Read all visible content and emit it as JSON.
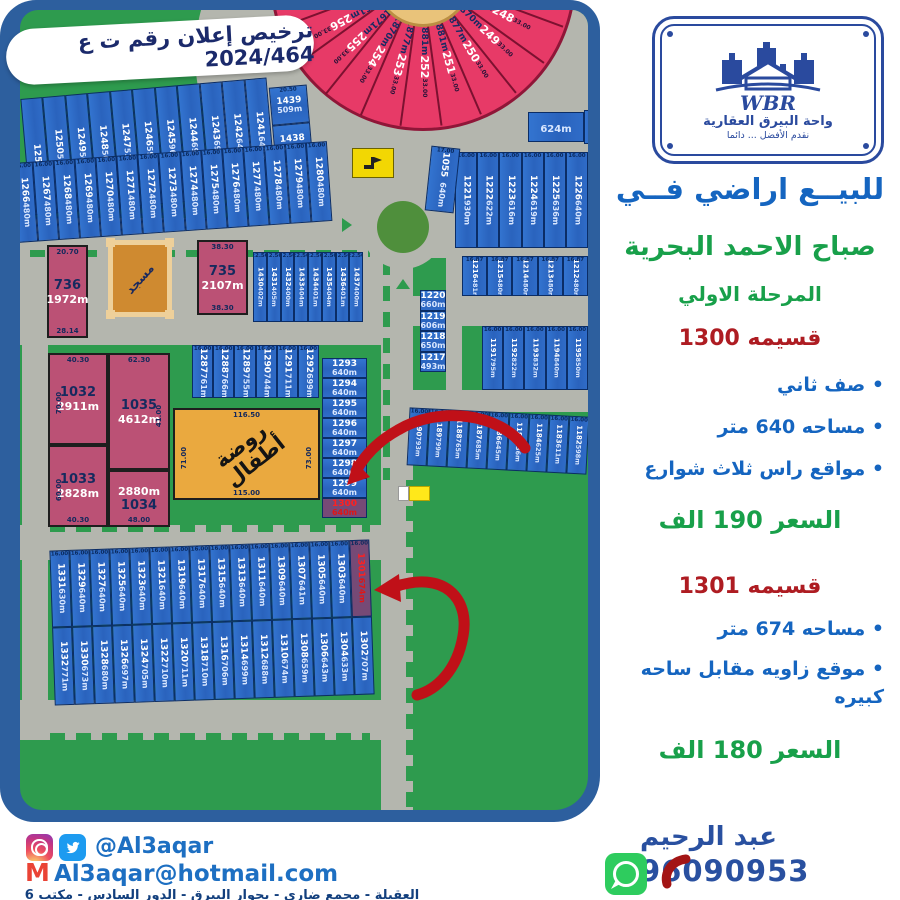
{
  "license_banner": "ترخيص إعلان رقم ت ع 2024/464",
  "logo": {
    "wbr": "WBR",
    "name": "واحة البيرق العقارية",
    "slogan": "نقدم الأفضل ... دائما"
  },
  "panel": {
    "title": "للبيــع اراضي فــي",
    "subtitle": "صباح الاحمد البحرية",
    "phase": "المرحلة الاولي",
    "sections": [
      {
        "heading": "قسيمه 1300",
        "bullets": [
          "صف ثاني",
          "مساحه 640 متر",
          "مواقع راس ثلاث شوارع"
        ],
        "price": "السعر 190 الف"
      },
      {
        "heading": "قسيمه 1301",
        "bullets": [
          "مساحه 674 متر",
          "موقع زاويه مقابل ساحه كبيره"
        ],
        "price": "السعر 180 الف"
      }
    ],
    "agent": "عبد الرحيم",
    "phone": "96090953"
  },
  "contact": {
    "social_handle": "@Al3aqar",
    "email": "Al3aqar@hotmail.com",
    "address": "العقيلة - مجمع ضاري - بجوار البيرق - الدور السادس - مكتب 6"
  },
  "map": {
    "mosque": "مسجد",
    "kindergarten": {
      "label": "روضة أطفال",
      "dt": "116.50",
      "dl": "71.00",
      "db": "115.00",
      "dr": "73.00"
    },
    "fan": {
      "arc_dim": "33.00",
      "wedges": [
        {
          "area": "1868m",
          "num": "248"
        },
        {
          "area": "1870m",
          "num": "249"
        },
        {
          "area": "1877m",
          "num": "250"
        },
        {
          "area": "1881m",
          "num": "251"
        },
        {
          "area": "1881m",
          "num": "252"
        },
        {
          "area": "1877m",
          "num": "253"
        },
        {
          "area": "1870m",
          "num": "254"
        },
        {
          "area": "1671m",
          "num": "255"
        },
        {
          "area": "1661m",
          "num": "256"
        }
      ]
    },
    "plots": {
      "p736": {
        "n": "736",
        "a": "1972m",
        "dt": "20.70",
        "db": "28.14"
      },
      "p735": {
        "n": "735",
        "a": "2107m",
        "dt": "38.30",
        "db": "38.30"
      },
      "p1032": {
        "n": "1032",
        "a": "2911m",
        "dt": "40.30",
        "dl": "70.00"
      },
      "p1035": {
        "n": "1035",
        "a": "4612m",
        "dt": "62.30",
        "dr": "41.00"
      },
      "p1033": {
        "n": "1033",
        "a": "2828m",
        "dl": "60.00",
        "db": "40.30"
      },
      "p1034": {
        "n": "1034",
        "a": "2880m",
        "db": "48.00"
      },
      "p624": {
        "a": "624m"
      },
      "p986": {
        "n": "986"
      },
      "p1055": {
        "n": "1055",
        "a": "640m",
        "d": "17.00"
      }
    },
    "rows": {
      "r1251": {
        "plots": [
          {
            "n": "1251",
            "a": ""
          },
          {
            "n": "1250",
            "a": "522m"
          },
          {
            "n": "1249",
            "a": "507m"
          },
          {
            "n": "1248",
            "a": "505m"
          },
          {
            "n": "1247",
            "a": "531m"
          },
          {
            "n": "1246",
            "a": "598m"
          },
          {
            "n": "1245",
            "a": "969m"
          },
          {
            "n": "1244",
            "a": "695m"
          },
          {
            "n": "1243",
            "a": "695m"
          },
          {
            "n": "1242",
            "a": "640m"
          },
          {
            "n": "1241",
            "a": "640m"
          }
        ]
      },
      "c1439": {
        "plots": [
          {
            "n": "1439",
            "a": "509m",
            "d": "20.50"
          },
          {
            "n": "1438",
            "a": "532m"
          }
        ]
      },
      "r1266": {
        "dim": "16.00",
        "plots": [
          {
            "n": "1266",
            "a": "480m"
          },
          {
            "n": "1267",
            "a": "480m"
          },
          {
            "n": "1268",
            "a": "480m"
          },
          {
            "n": "1269",
            "a": "480m"
          },
          {
            "n": "1270",
            "a": "480m"
          },
          {
            "n": "1271",
            "a": "480m"
          },
          {
            "n": "1272",
            "a": "480m"
          },
          {
            "n": "1273",
            "a": "480m"
          },
          {
            "n": "1274",
            "a": "480m"
          },
          {
            "n": "1275",
            "a": "480m"
          },
          {
            "n": "1276",
            "a": "480m"
          },
          {
            "n": "1277",
            "a": "480m"
          },
          {
            "n": "1278",
            "a": "480m"
          },
          {
            "n": "1279",
            "a": "480m"
          },
          {
            "n": "1280",
            "a": "480m"
          }
        ]
      },
      "r1430": {
        "dim": "22.50",
        "plots": [
          {
            "n": "1430",
            "a": "402m"
          },
          {
            "n": "1431",
            "a": "405m"
          },
          {
            "n": "1432",
            "a": "400m"
          },
          {
            "n": "1433",
            "a": "404m"
          },
          {
            "n": "1434",
            "a": "401m"
          },
          {
            "n": "1435",
            "a": "404m"
          },
          {
            "n": "1436",
            "a": "401m"
          },
          {
            "n": "1437",
            "a": "400m"
          }
        ]
      },
      "r1287": {
        "dim": "16.00",
        "plots": [
          {
            "n": "1287",
            "a": "761m"
          },
          {
            "n": "1288",
            "a": "766m"
          },
          {
            "n": "1289",
            "a": "755m"
          },
          {
            "n": "1290",
            "a": "744m"
          },
          {
            "n": "1291",
            "a": "711m"
          },
          {
            "n": "1292",
            "a": "699m"
          }
        ]
      },
      "c1293": {
        "plots": [
          {
            "n": "1293",
            "a": "640m"
          },
          {
            "n": "1294",
            "a": "640m"
          },
          {
            "n": "1295",
            "a": "640m"
          },
          {
            "n": "1296",
            "a": "640m"
          },
          {
            "n": "1297",
            "a": "640m"
          },
          {
            "n": "1298",
            "a": "640m"
          },
          {
            "n": "1299",
            "a": "640m"
          },
          {
            "n": "1300",
            "a": "640m",
            "hl": true
          }
        ]
      },
      "r1221": {
        "dim": "16.00",
        "plots": [
          {
            "n": "1221",
            "a": "930m"
          },
          {
            "n": "1222",
            "a": "622m"
          },
          {
            "n": "1223",
            "a": "616m"
          },
          {
            "n": "1224",
            "a": "619m"
          },
          {
            "n": "1225",
            "a": "636m"
          },
          {
            "n": "1226",
            "a": "640m"
          }
        ]
      },
      "r1216": {
        "dim": "16.87",
        "plots": [
          {
            "n": "1216",
            "a": "481m"
          },
          {
            "n": "1215",
            "a": "480m"
          },
          {
            "n": "1214",
            "a": "480m"
          },
          {
            "n": "1213",
            "a": "480m"
          },
          {
            "n": "1212",
            "a": "480m"
          }
        ]
      },
      "c1220": {
        "plots": [
          {
            "n": "1220",
            "a": "660m"
          },
          {
            "n": "1219",
            "a": "606m"
          },
          {
            "n": "1218",
            "a": "650m"
          },
          {
            "n": "1217",
            "a": "493m"
          }
        ]
      },
      "r1191": {
        "dim": "16.00",
        "plots": [
          {
            "n": "1191",
            "a": "795m"
          },
          {
            "n": "1192",
            "a": "822m"
          },
          {
            "n": "1193",
            "a": "832m"
          },
          {
            "n": "1194",
            "a": "840m"
          },
          {
            "n": "1195",
            "a": "850m"
          }
        ]
      },
      "r1190": {
        "dim": "16.00",
        "plots": [
          {
            "n": "1190",
            "a": "793m"
          },
          {
            "n": "1189",
            "a": "799m"
          },
          {
            "n": "1188",
            "a": "765m"
          },
          {
            "n": "1187",
            "a": "685m"
          },
          {
            "n": "1186",
            "a": "645m"
          },
          {
            "n": "1185",
            "a": "636m"
          },
          {
            "n": "1184",
            "a": "625m"
          },
          {
            "n": "1183",
            "a": "611m"
          },
          {
            "n": "1182",
            "a": "598m"
          }
        ]
      },
      "rbot1": {
        "dim": "16.00",
        "plots": [
          {
            "n": "1331",
            "a": "630m"
          },
          {
            "n": "1329",
            "a": "640m"
          },
          {
            "n": "1327",
            "a": "640m"
          },
          {
            "n": "1325",
            "a": "640m"
          },
          {
            "n": "1323",
            "a": "640m"
          },
          {
            "n": "1321",
            "a": "640m"
          },
          {
            "n": "1319",
            "a": "640m"
          },
          {
            "n": "1317",
            "a": "640m"
          },
          {
            "n": "1315",
            "a": "640m"
          },
          {
            "n": "1313",
            "a": "640m"
          },
          {
            "n": "1311",
            "a": "640m"
          },
          {
            "n": "1309",
            "a": "640m"
          },
          {
            "n": "1307",
            "a": "641m"
          },
          {
            "n": "1305",
            "a": "640m"
          },
          {
            "n": "1303",
            "a": "640m"
          },
          {
            "n": "1301",
            "a": "674m",
            "hl": true
          }
        ]
      },
      "rbot2": {
        "plots": [
          {
            "n": "1332",
            "a": "771m"
          },
          {
            "n": "1330",
            "a": "673m"
          },
          {
            "n": "1328",
            "a": "680m"
          },
          {
            "n": "1326",
            "a": "697m"
          },
          {
            "n": "1324",
            "a": "705m"
          },
          {
            "n": "1322",
            "a": "710m"
          },
          {
            "n": "1320",
            "a": "711m"
          },
          {
            "n": "1318",
            "a": "710m"
          },
          {
            "n": "1316",
            "a": "706m"
          },
          {
            "n": "1314",
            "a": "699m"
          },
          {
            "n": "1312",
            "a": "688m"
          },
          {
            "n": "1310",
            "a": "674m"
          },
          {
            "n": "1308",
            "a": "659m"
          },
          {
            "n": "1306",
            "a": "643m"
          },
          {
            "n": "1304",
            "a": "633m"
          },
          {
            "n": "1302",
            "a": "707m"
          }
        ]
      }
    }
  },
  "colors": {
    "map_green": "#2e9b4e",
    "road_gray": "#b4b6ae",
    "plot_blue": "#2e6bc8",
    "fan_pink": "#e73a67",
    "plot_rose": "#bb5175",
    "highlight_purple": "#764a76",
    "arrow_red": "#c01018",
    "accent_blue": "#1565c0",
    "accent_green": "#18a04a",
    "accent_red": "#ae1c22",
    "navy": "#2a4a9e",
    "orange": "#eaa93f"
  }
}
